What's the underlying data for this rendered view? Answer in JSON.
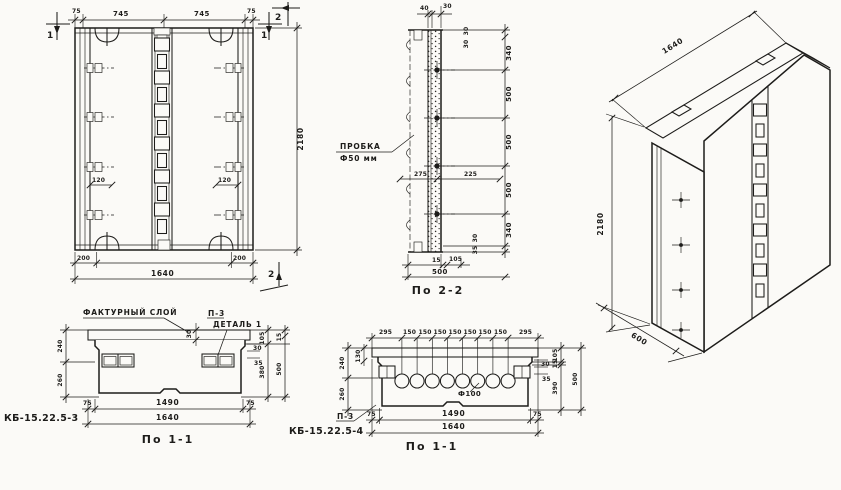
{
  "paper": "#fbfaf7",
  "ink": "#1d1c1a",
  "views": {
    "front": {
      "marks": {
        "sec1": "1",
        "sec2": "2"
      },
      "dims": {
        "edge_l": "75",
        "span_l": "745",
        "span_r": "745",
        "edge_r": "75",
        "loop_off_l": "200",
        "loop_off_r": "200",
        "width_total": "1640",
        "height": "2180",
        "anchor_l": "120",
        "anchor_r": "120"
      }
    },
    "sec22": {
      "caption": "По 2-2",
      "plug_label_1": "ПРОБКА",
      "plug_label_2": "Ф50 мм",
      "dims": {
        "top_a": "40",
        "top_b": "30",
        "side_top_a": "30",
        "side_top_b": "30",
        "v1": "340",
        "v2": "500",
        "v3": "500",
        "v4": "500",
        "v5": "340",
        "side_bot_a": "30",
        "side_bot_b": "35",
        "plug_front": "275",
        "plug_back": "225",
        "bot_a": "15",
        "bot_b": "105",
        "depth": "500"
      }
    },
    "sec11a": {
      "caption": "По 1-1",
      "mark": "КБ-15.22.5-3",
      "label_texture": "ФАКТУРНЫЙ СЛОЙ",
      "label_p3": "П-3",
      "label_detail": "ДЕТАЛЬ 1",
      "dims": {
        "facing": "30",
        "left_a": "240",
        "left_b": "260",
        "step_a": "30",
        "step_b": "35",
        "right_in_a": "105",
        "right_in_b": "380",
        "right_out_a": "15",
        "right_out_b": "500",
        "bot_edge_l": "75",
        "bot_span": "1490",
        "bot_edge_r": "75",
        "bot_total": "1640"
      }
    },
    "sec11b": {
      "caption": "По 1-1",
      "mark": "КБ-15.22.5-4",
      "label_p3": "П-3",
      "label_hole": "Ф100",
      "dims": {
        "top_edge_l": "295",
        "top_step": "150",
        "top_edge_r": "295",
        "left_0": "130",
        "left_a": "240",
        "left_b": "260",
        "step_a": "30",
        "step_b": "35",
        "right_a": "105",
        "right_b": "15",
        "right_c": "390",
        "right_d": "500",
        "bot_edge_l": "75",
        "bot_span": "1490",
        "bot_edge_r": "75",
        "bot_total": "1640"
      }
    },
    "iso": {
      "dims": {
        "width": "1640",
        "height": "2180",
        "depth": "600"
      }
    }
  }
}
